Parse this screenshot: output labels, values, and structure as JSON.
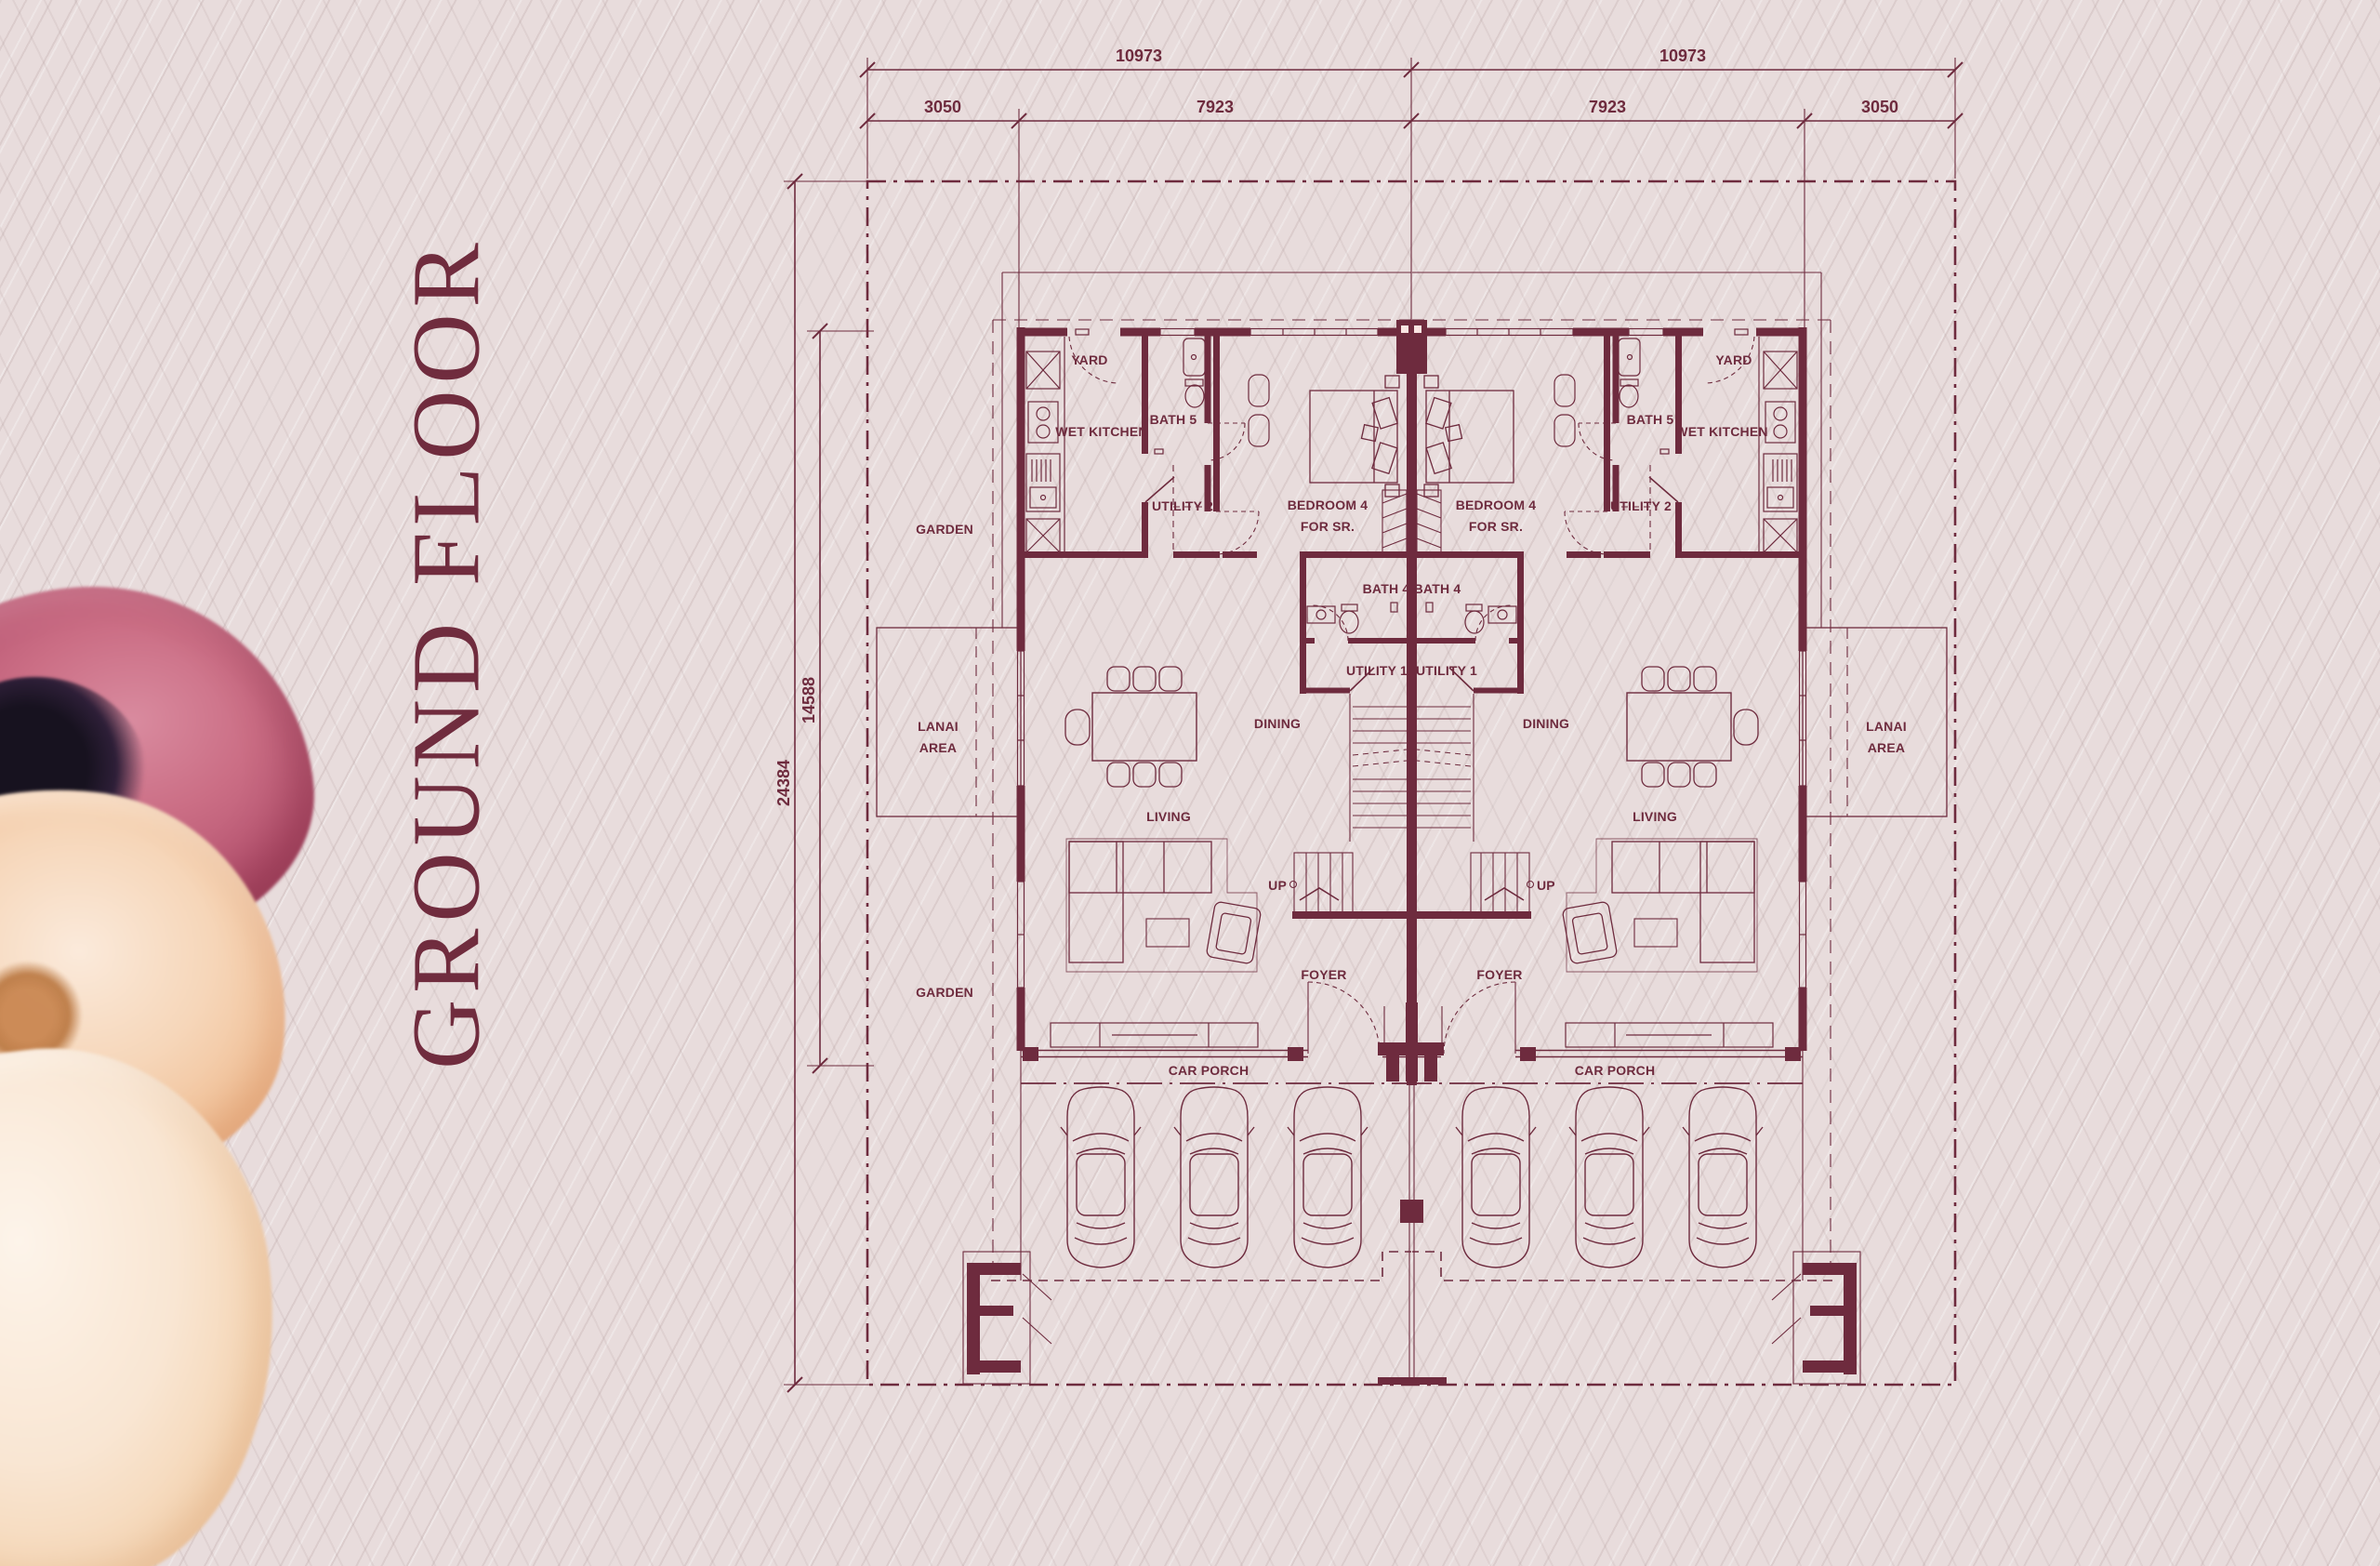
{
  "title": "GROUND FLOOR",
  "plan": {
    "dimensions": {
      "top_total_left": "10973",
      "top_total_right": "10973",
      "seg_left_outer": "3050",
      "seg_left_inner": "7923",
      "seg_right_inner": "7923",
      "seg_right_outer": "3050",
      "side_total": "24384",
      "side_inner": "14588"
    },
    "labels": {
      "yard": "YARD",
      "wet_kitchen": "WET KITCHEN",
      "bath5": "BATH 5",
      "utility2": "UTILITY 2",
      "bedroom4_line1": "BEDROOM 4",
      "bedroom4_line2": "FOR SR.",
      "bath4": "BATH 4",
      "utility1": "UTILITY 1",
      "dining": "DINING",
      "living": "LIVING",
      "foyer": "FOYER",
      "up": "UP",
      "car_porch": "CAR PORCH",
      "garden": "GARDEN",
      "lanai_line1": "LANAI",
      "lanai_line2": "AREA"
    },
    "colors": {
      "line": "#6E2B3E",
      "fill": "#FAE5E2",
      "background": "#E8DCDC",
      "title": "#702C3E",
      "flower_pink": "#B85672",
      "flower_cream": "#F3CFA9"
    }
  }
}
